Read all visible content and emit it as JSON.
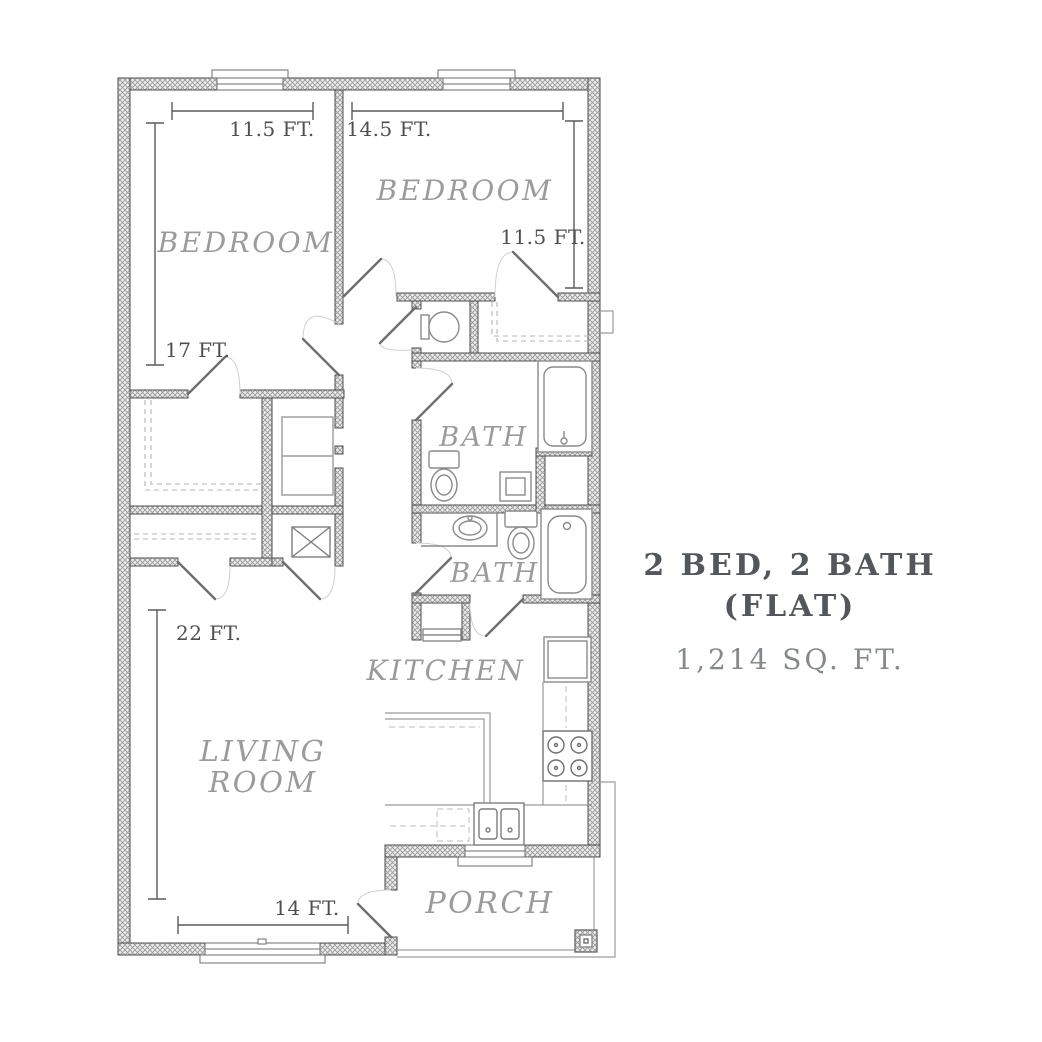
{
  "plan": {
    "rooms": [
      {
        "name": "bedroom-left",
        "label": "BEDROOM"
      },
      {
        "name": "bedroom-right",
        "label": "BEDROOM"
      },
      {
        "name": "bath-upper",
        "label": "BATH"
      },
      {
        "name": "bath-lower",
        "label": "BATH"
      },
      {
        "name": "kitchen",
        "label": "KITCHEN"
      },
      {
        "name": "living-room",
        "label_line1": "LIVING",
        "label_line2": "ROOM"
      },
      {
        "name": "porch",
        "label": "PORCH"
      }
    ],
    "dimensions": [
      {
        "name": "bedroom-left-width",
        "label": "11.5 FT."
      },
      {
        "name": "bedroom-right-width",
        "label": "14.5 FT."
      },
      {
        "name": "bedroom-right-depth",
        "label": "11.5 FT."
      },
      {
        "name": "bedroom-left-depth",
        "label": "17 FT."
      },
      {
        "name": "living-room-depth",
        "label": "22 FT."
      },
      {
        "name": "living-room-width",
        "label": "14 FT."
      }
    ]
  },
  "info_panel": {
    "title_line1": "2 BED, 2 BATH",
    "title_line2": "(FLAT)",
    "area": "1,214 SQ. FT."
  },
  "colors": {
    "title_text": "#53575b",
    "area_text": "#85898c",
    "room_label": "#9b9b9b",
    "dimension_text": "#4f4f4f",
    "wall_outline": "#4d4d4d",
    "wall_hatch": "#9a9a9a",
    "fixture_line": "#8a8a8a"
  }
}
